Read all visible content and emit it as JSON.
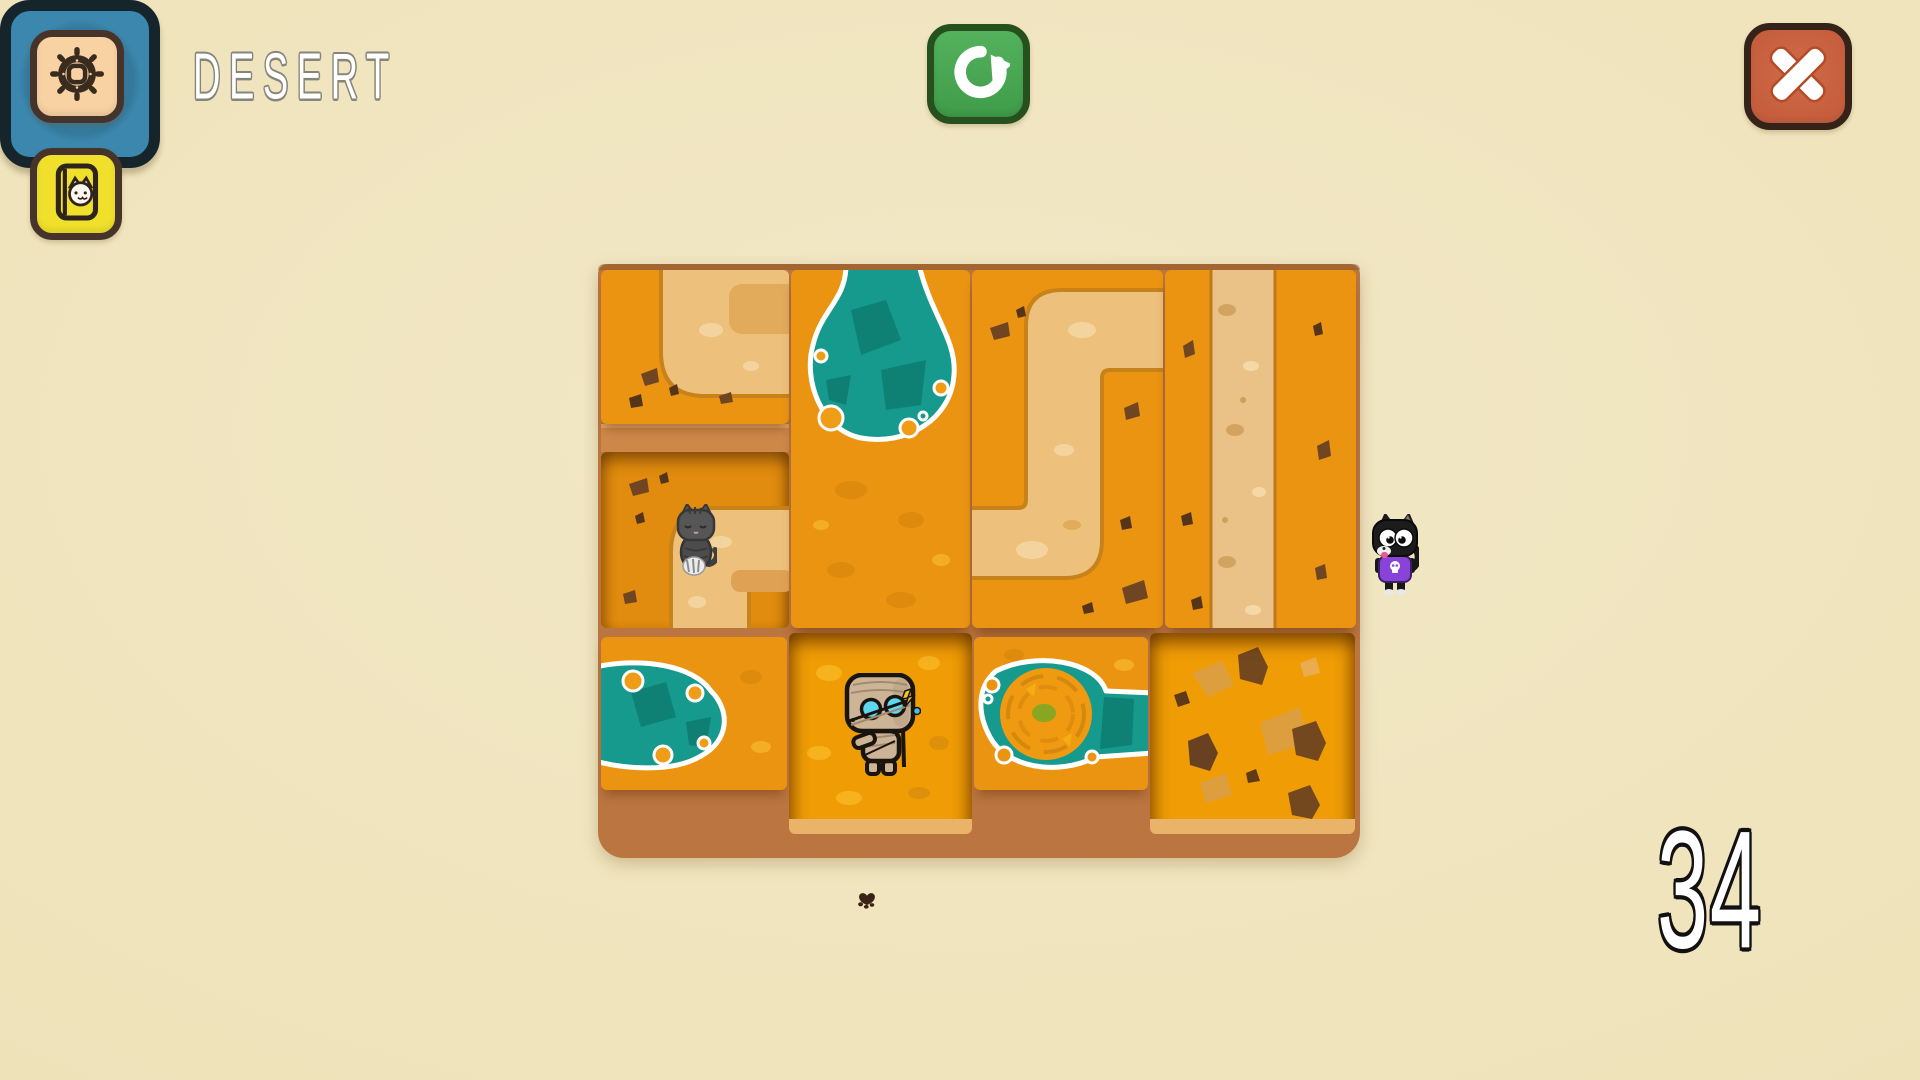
{
  "title": {
    "text": "DESERT"
  },
  "counter": {
    "value": "34"
  },
  "buttons": {
    "settings": {
      "icon": "gear-icon"
    },
    "cat_book": {
      "icon": "cat-book-icon"
    },
    "restart": {
      "icon": "restart-arrow-icon"
    },
    "close": {
      "icon": "close-x-icon"
    },
    "play": {
      "icon": "play-triangle-icon"
    }
  },
  "hud": {
    "paw_icon": "paw-print-icon"
  },
  "colors": {
    "background": "#efe4bc",
    "tile_orange": "#ea9412",
    "path_sand": "#edc17c",
    "water_teal": "#169a8d",
    "tray_brown": "#bb7540",
    "restart_green": "#42a14c",
    "close_red": "#c75f3e",
    "play_blue": "#3c87ad",
    "book_yellow": "#f0e02c",
    "settings_peach": "#f8d2a2"
  },
  "board": {
    "rows": 3,
    "columns": 4,
    "tiles": [
      {
        "name": "path-corner-tile-top-left",
        "row": "1",
        "col": "1",
        "type": "path corner (top to right)"
      },
      {
        "name": "cat-path-corner-tile",
        "row": "2",
        "col": "1",
        "type": "path corner (right to bottom)",
        "occupant": "gray-cat"
      },
      {
        "name": "oasis-pond-tile",
        "row": "1-2",
        "col": "2",
        "type": "pond at top"
      },
      {
        "name": "zigzag-path-tile",
        "row": "1-2",
        "col": "3",
        "type": "Z-shaped path (right-top to left-bottom)"
      },
      {
        "name": "vertical-road-tile",
        "row": "1-2",
        "col": "4",
        "type": "vertical sand road"
      },
      {
        "name": "pond-left-tile",
        "row": "3",
        "col": "1",
        "type": "pond from left edge"
      },
      {
        "name": "mummy-slot",
        "row": "3",
        "col": "2",
        "type": "recessed empty slot",
        "occupant": "mummy"
      },
      {
        "name": "whirlpool-pond-tile",
        "row": "3",
        "col": "3",
        "type": "pond with whirlpool island"
      },
      {
        "name": "rocky-slot",
        "row": "3",
        "col": "4",
        "type": "recessed slot with rocks"
      }
    ],
    "characters": [
      {
        "name": "gray-cat",
        "location": "row 2 col 1 tile, at path corner"
      },
      {
        "name": "mummy",
        "location": "row 3 col 2 recessed slot"
      },
      {
        "name": "black-cat",
        "location": "right of board, beside play button"
      }
    ]
  }
}
